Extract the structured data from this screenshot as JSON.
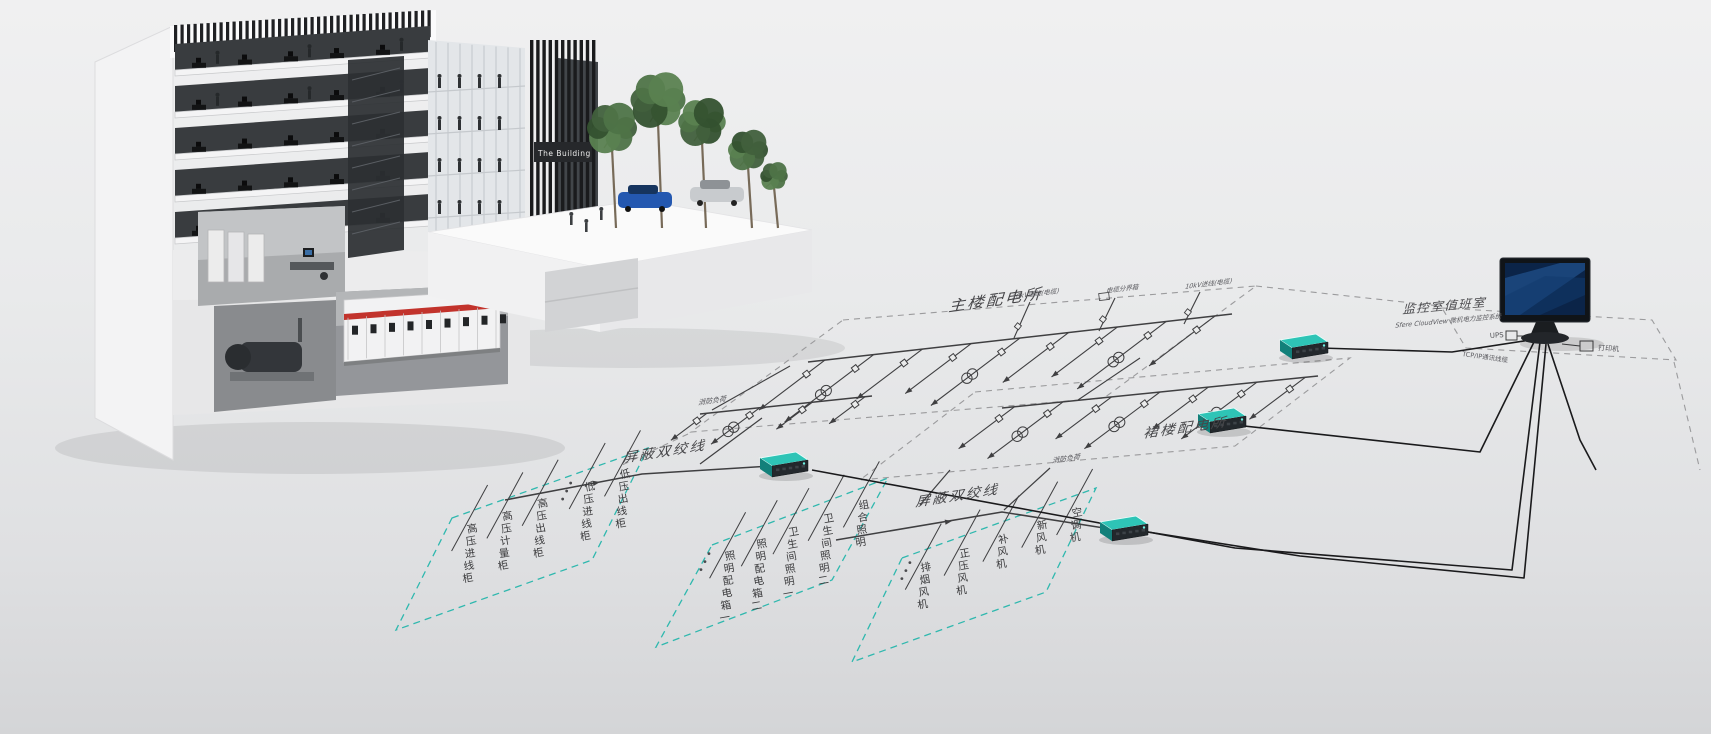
{
  "building": {
    "sign": "The Building"
  },
  "diagram": {
    "substations": {
      "main": {
        "title": "主楼配电所",
        "incoming": [
          "10kV进线(电缆)",
          "电缆分界箱",
          "10kV进线(电缆)"
        ],
        "load_note": "消防负荷"
      },
      "podium": {
        "title": "裙楼配电所",
        "load_note": "消防负荷"
      }
    },
    "monitoring_room": {
      "title": "监控室值班室",
      "subtitle": "Sfere CloudView 微机电力监控系统",
      "ups": "UPS",
      "printer": "打印机",
      "cable": "TCP/IP通讯线缆"
    },
    "bus1_label": "屏蔽双绞线",
    "bus2_label": "屏蔽双绞线",
    "ellipsis": "···",
    "feeder_groups": [
      {
        "id": "hv-cabinets",
        "labels": [
          "高压进线柜",
          "高压计量柜",
          "高压出线柜",
          "低压进线柜",
          "低压出线柜"
        ]
      },
      {
        "id": "lighting",
        "labels": [
          "照明配电箱一",
          "照明配电箱二",
          "卫生间照明一",
          "卫生间照明二",
          "组合照明"
        ]
      },
      {
        "id": "hvac-fans",
        "labels": [
          "排烟风机",
          "正压风机",
          "补风机",
          "新风机",
          "空调机"
        ]
      }
    ],
    "colors": {
      "accent_teal": "#2fb8ae",
      "diagram_line": "#3f3f41",
      "dashed_gray": "#9b9b9d",
      "device_teal": "#2ec4b6",
      "screen_blue": "#16457f",
      "cable_black": "#1a1a1c",
      "stripe_red": "#c2332c"
    }
  }
}
